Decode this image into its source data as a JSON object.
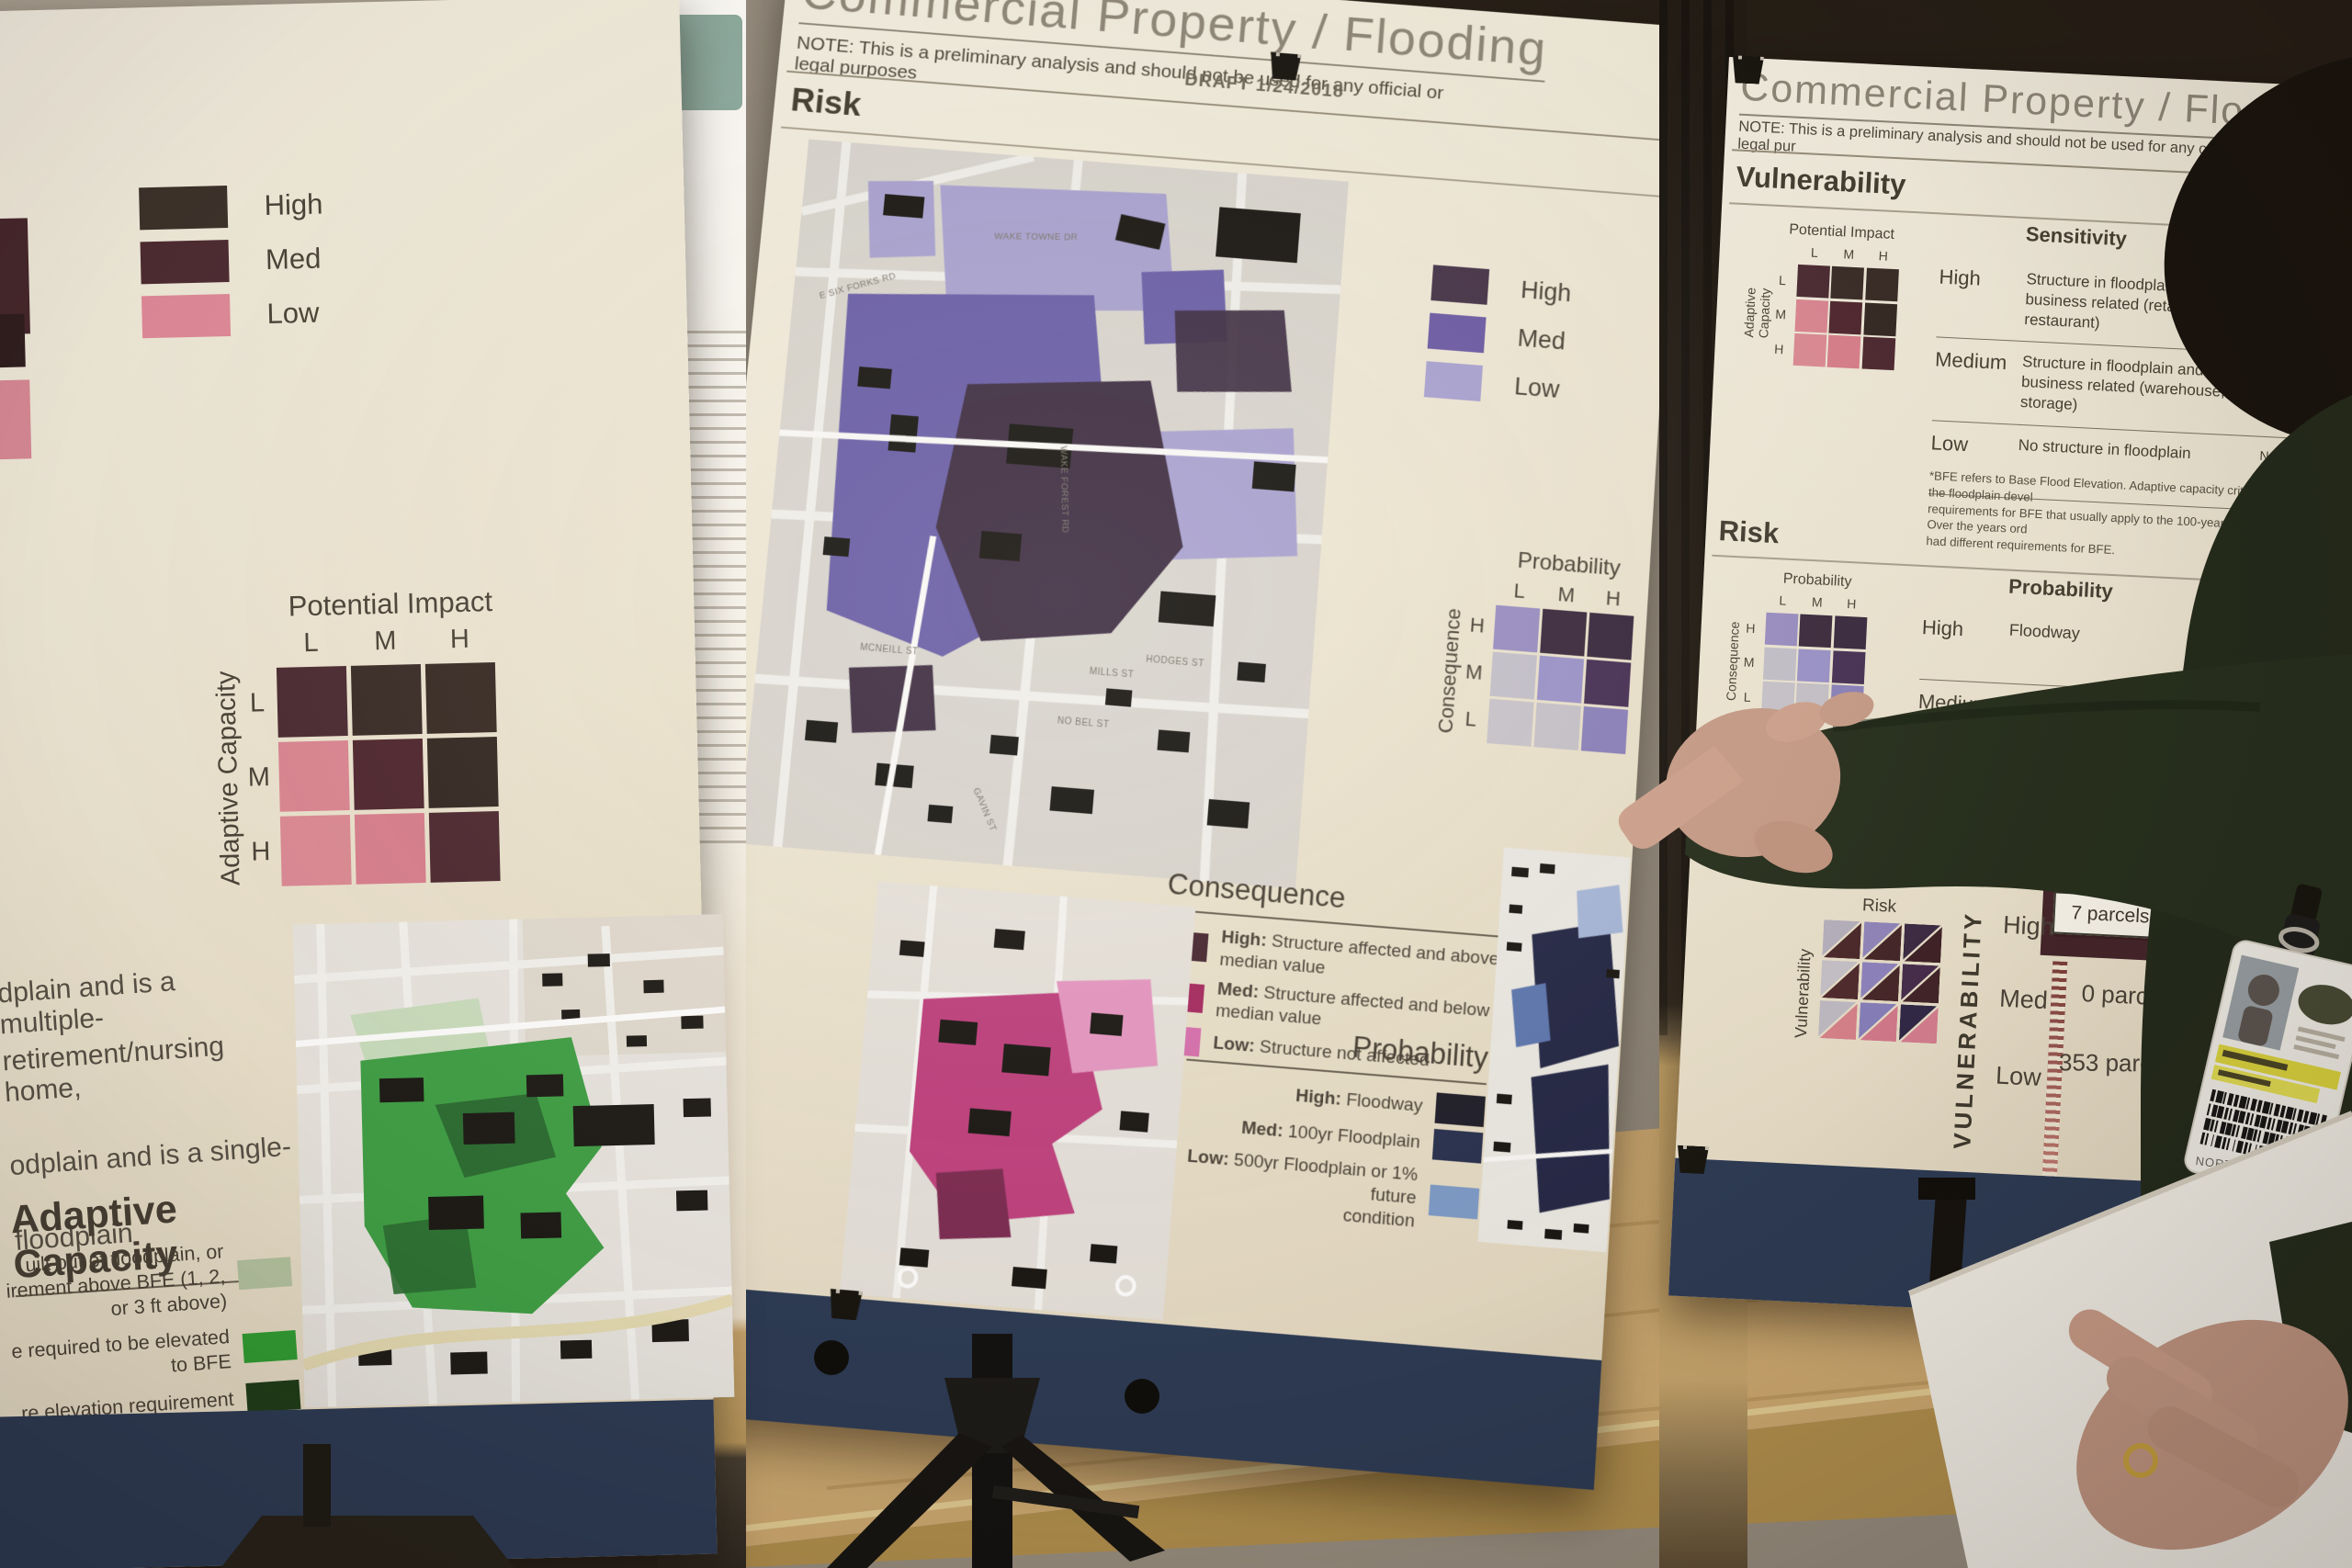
{
  "left_poster": {
    "legend": [
      {
        "label": "High",
        "color": "#3b312b"
      },
      {
        "label": "Med",
        "color": "#4c2b32"
      },
      {
        "label": "Low",
        "color": "#e28a9b"
      }
    ],
    "impact_matrix": {
      "title": "Potential Impact",
      "col_labels": [
        "L",
        "M",
        "H"
      ],
      "row_axis": "Adaptive Capacity",
      "row_labels": [
        "L",
        "M",
        "H"
      ],
      "cells": [
        [
          "#4a2a33",
          "#382b27",
          "#372a25"
        ],
        [
          "#dc8794",
          "#4f2730",
          "#332823"
        ],
        [
          "#dd8b96",
          "#d97f8e",
          "#4c2831"
        ]
      ]
    },
    "fragments": [
      "dplain and is a multiple-",
      "retirement/nursing home,",
      "odplain and is a single-",
      "floodplain"
    ],
    "adaptive_heading": "Adaptive Capacity",
    "adaptive_legend": [
      {
        "lines": [
          "uilt out of floodplain, or",
          "irement above BFE (1, 2,",
          "or 3 ft above)"
        ],
        "color": "#b6c5a3"
      },
      {
        "lines": [
          "e required to be elevated",
          "to BFE"
        ],
        "color": "#2f9e33"
      },
      {
        "lines": [
          "re elevation requirement"
        ],
        "color": "#1e3c18"
      }
    ]
  },
  "middle_poster": {
    "title": "Commercial Property / Flooding",
    "note": "NOTE: This is a preliminary analysis and should not be used for any official or legal purposes",
    "draft": "DRAFT 1/24/2018",
    "section_heading": "Risk",
    "legend": [
      {
        "label": "High",
        "color": "#453349"
      },
      {
        "label": "Med",
        "color": "#6b5ba6"
      },
      {
        "label": "Low",
        "color": "#a9a3d3"
      }
    ],
    "risk_matrix": {
      "title": "Probability",
      "col_labels": [
        "L",
        "M",
        "H"
      ],
      "row_axis": "Consequence",
      "row_labels": [
        "H",
        "M",
        "L"
      ],
      "cells": [
        [
          "#9a8fc4",
          "#3a2a3e",
          "#3a2a40"
        ],
        [
          "#c5c2cc",
          "#9b94cb",
          "#473157"
        ],
        [
          "#c8c5cd",
          "#c6c3cb",
          "#8b82bd"
        ]
      ]
    },
    "consequence_legend": {
      "title": "Consequence",
      "items": [
        {
          "label": "High:",
          "text": "Structure affected and above median value",
          "color": "#472732"
        },
        {
          "label": "Med:",
          "text": "Structure affected and below median value",
          "color": "#a62961"
        },
        {
          "label": "Low:",
          "text": "Structure not affected",
          "color": "#d76fae"
        }
      ]
    },
    "probability_legend": {
      "title": "Probability",
      "items": [
        {
          "label": "High:",
          "lines": [
            "Floodway"
          ],
          "color": "#1d1d29"
        },
        {
          "label": "Med:",
          "lines": [
            "100yr Floodplain"
          ],
          "color": "#28304f"
        },
        {
          "label": "Low:",
          "lines": [
            "500yr Floodplain or 1% future",
            "condition"
          ],
          "color": "#7d9cc9"
        }
      ]
    },
    "street_labels": [
      "WAKE TOWNE DR",
      "E SIX FORKS RD",
      "WAKE FOREST RD",
      "MCNEILL ST",
      "MILLS ST",
      "NO BEL ST",
      "GAVIN ST",
      "HODGES ST"
    ]
  },
  "right_poster": {
    "title": "Commercial Property / Flooding",
    "note": "NOTE: This is a preliminary analysis and should not be used for any official or legal pur",
    "draft": "DRAFT 1/2",
    "vulnerability": {
      "heading": "Vulnerability",
      "matrix": {
        "title": "Potential Impact",
        "col_labels": [
          "L",
          "M",
          "H"
        ],
        "row_axis": "Adaptive Capacity",
        "row_labels": [
          "L",
          "M",
          "H"
        ],
        "cells": [
          [
            "#4a2a33",
            "#382b27",
            "#372a25"
          ],
          [
            "#dc8794",
            "#4f2730",
            "#332823"
          ],
          [
            "#dd8b96",
            "#d97f8e",
            "#4c2831"
          ]
        ]
      },
      "sensitivity": {
        "header": "Sensitivity",
        "rows": [
          {
            "level": "High",
            "desc": "Structure in floodplain and business related (retail, hotel, restaurant)",
            "adaptive": [
              "or ele",
              "BFE (1, 2, or 3 ft above)"
            ]
          },
          {
            "level": "Medium",
            "desc": "Structure in floodplain and not business related (warehouse, storage)",
            "adaptive": [
              "Structure required to b",
              "to BFE"
            ]
          },
          {
            "level": "Low",
            "desc": "No structure in floodplain",
            "adaptive": [
              "No structure elev",
              "requirement"
            ]
          }
        ]
      },
      "footnote_lines": [
        "*BFE refers to Base Flood Elevation. Adaptive capacity criteria are based on the floodplain devel",
        "requirements for BFE that usually apply to the 100-year regulatory floodplain. Over the years ord",
        "had different requirements for BFE."
      ]
    },
    "risk": {
      "heading": "Risk",
      "matrix": {
        "title": "Probability",
        "col_labels": [
          "L",
          "M",
          "H"
        ],
        "row_axis": "Consequence",
        "row_labels": [
          "H",
          "M",
          "L"
        ],
        "cells": [
          [
            "#9a8fc4",
            "#3a2a3e",
            "#3a2a40"
          ],
          [
            "#c5c2cc",
            "#9b94cb",
            "#473157"
          ],
          [
            "#c8c5cd",
            "#c6c3cb",
            "#8b82bd"
          ]
        ]
      },
      "table": {
        "prob_header": "Probability",
        "cons_header": "Consequence*",
        "rows": [
          {
            "level": "High",
            "prob": [
              "Floodway"
            ],
            "cons": [
              "Structure affected",
              "median value"
            ]
          },
          {
            "level": "Medium",
            "prob": [
              "100-yr Floodplain"
            ],
            "cons": [
              "S"
            ]
          },
          {
            "level": "Low",
            "prob": [
              "500-year floodplain, or 1% fut",
              "condition"
            ],
            "cons": []
          }
        ]
      }
    },
    "results": {
      "combo": {
        "top": "Risk",
        "side": "Vulnerability",
        "risk_cells": [
          [
            "#b7b2c0",
            "#9186bd",
            "#3b2a44"
          ],
          [
            "#c6c3ca",
            "#8f83c0",
            "#452c4c"
          ],
          [
            "#c0bcc6",
            "#8780bd",
            "#2e2747"
          ]
        ],
        "vuln_cells": [
          [
            "#4a282b",
            "#432528",
            "#3d2127"
          ],
          [
            "#4e292d",
            "#462629",
            "#3f2328"
          ],
          [
            "#d8828b",
            "#d47a8d",
            "#d67f92"
          ]
        ]
      },
      "axis": "VULNERABILITY",
      "rows": [
        {
          "level": "High",
          "value": "7 parcels"
        },
        {
          "level": "Med",
          "value": "0 parcels"
        },
        {
          "level": "Low",
          "value": "353 parcels"
        }
      ],
      "col2_value": "12"
    }
  },
  "badge": {
    "region": "NORTH CAROLINA"
  }
}
